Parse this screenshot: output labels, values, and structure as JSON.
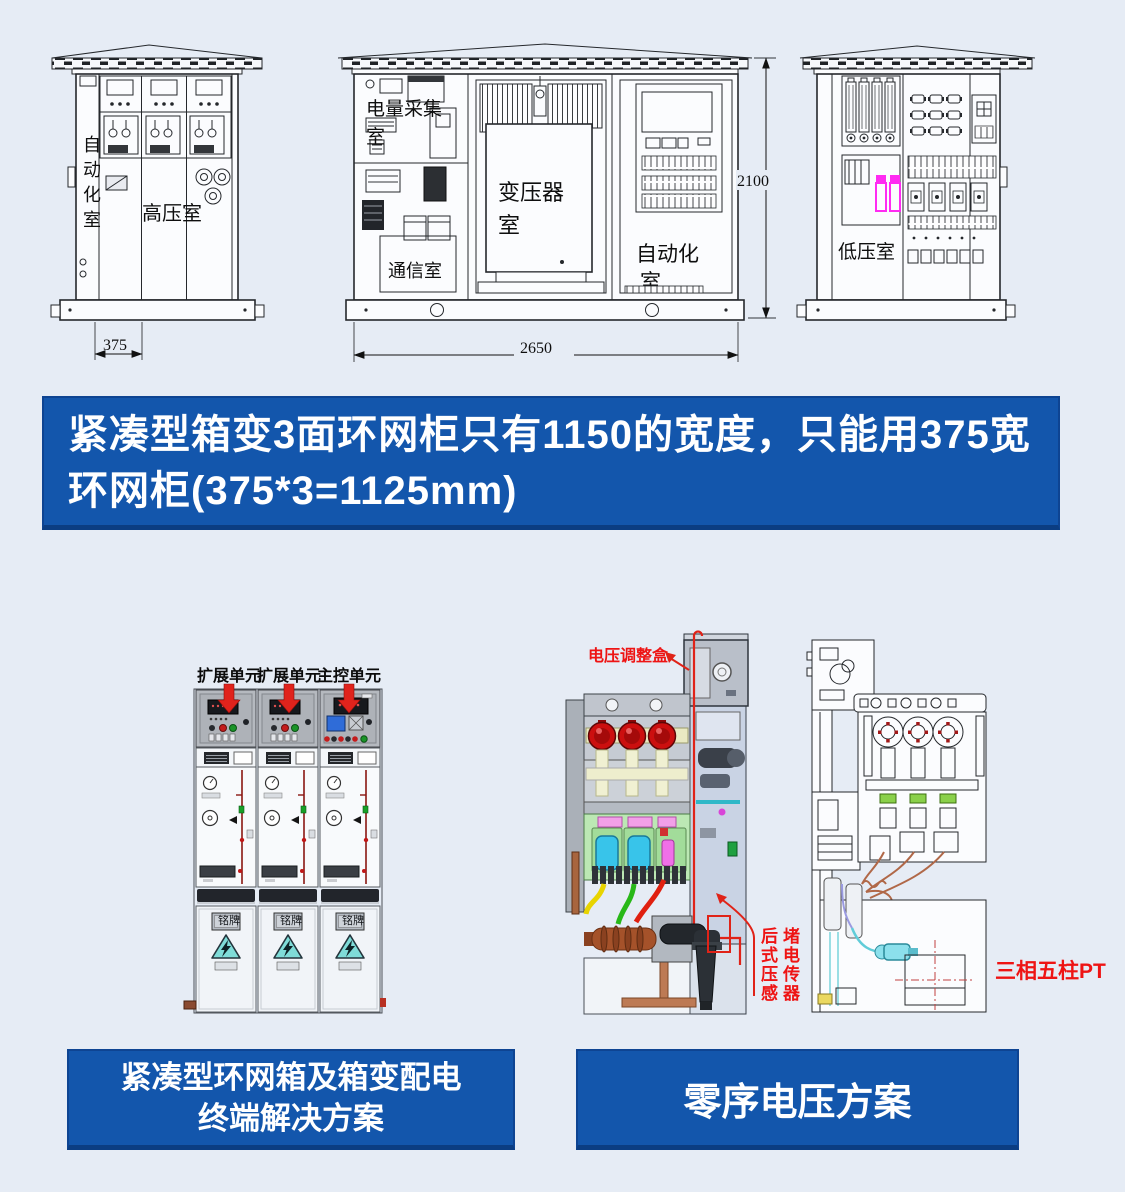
{
  "colors": {
    "page_bg": "#e6ecf5",
    "banner_blue": "#1356ac",
    "accent_red": "#e02318",
    "label_red": "#ee1414",
    "highlight_magenta": "#ff2bf2",
    "warning_cyan": "#7fdcd8"
  },
  "top": {
    "left_cabinet": {
      "side_label": "自动化室",
      "room": "高压室",
      "dim_width": "375"
    },
    "mid_cabinet": {
      "meter_room_l1": "电量采集",
      "meter_room_l2": "室",
      "comm_room": "通信室",
      "transformer_l1": "变压器",
      "transformer_l2": "室",
      "auto_room_l1": "自动化",
      "auto_room_l2": "室",
      "dim_width": "2650",
      "dim_height": "2100"
    },
    "right_cabinet": {
      "room": "低压室"
    }
  },
  "banner_main": {
    "line1": "紧凑型箱变3面环网柜只有1150的宽度，只能用375宽",
    "line2": "环网柜(375*3=1125mm)"
  },
  "rmu": {
    "units": [
      "扩展单元",
      "扩展单元",
      "主控单元"
    ],
    "nameplate": "铭牌"
  },
  "cutaway": {
    "voltage_box": "电压调整盒",
    "sensor_col_left": "后式压感",
    "sensor_col_right": "堵电传器"
  },
  "pt": {
    "label": "三相五柱PT"
  },
  "solution_left": {
    "line1": "紧凑型环网箱及箱变配电",
    "line2": "终端解决方案"
  },
  "solution_right": {
    "label": "零序电压方案"
  }
}
